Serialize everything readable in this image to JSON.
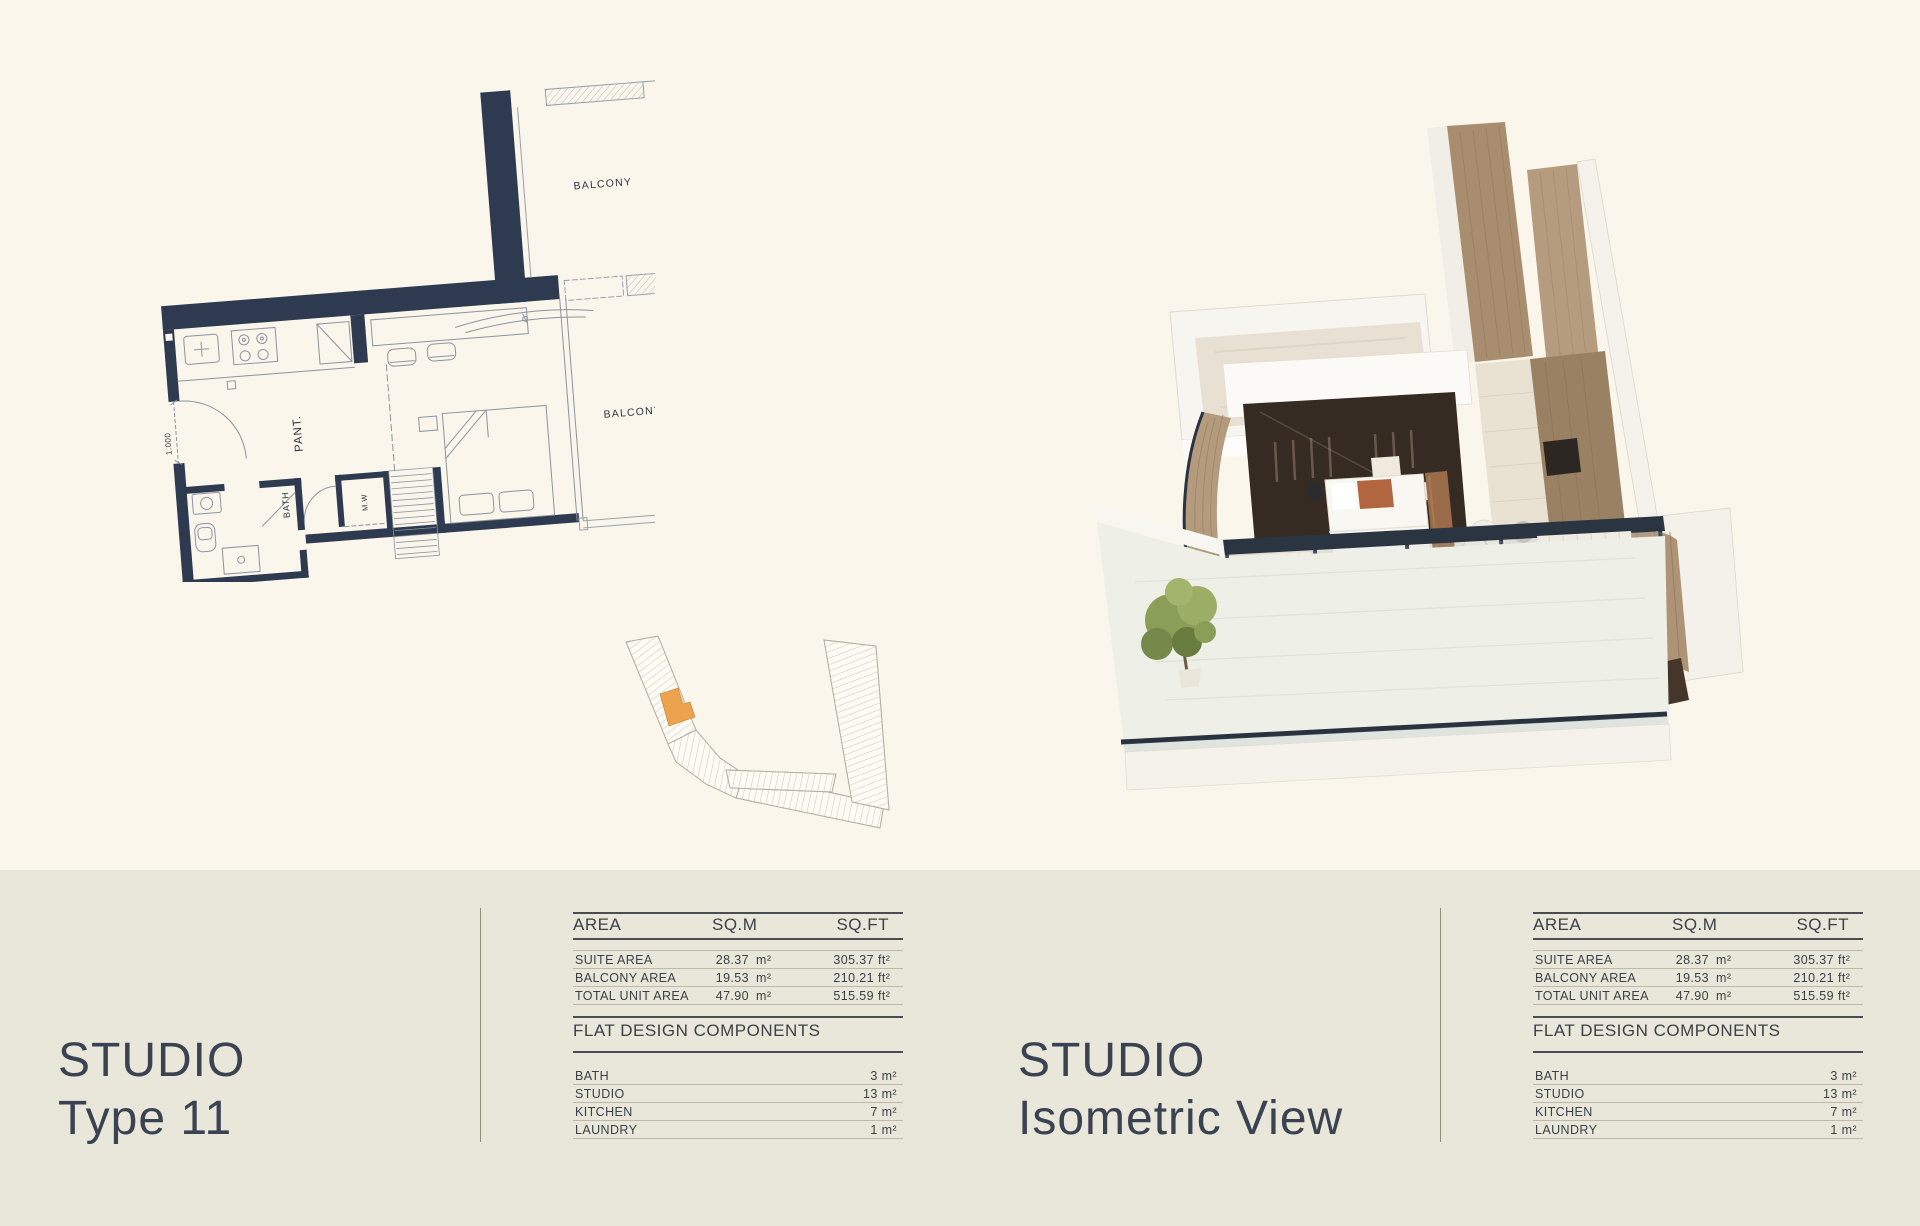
{
  "page": {
    "background_top": "#FAF6EC",
    "background_bottom": "#E9E7DA",
    "wall_navy": "#2d3a50",
    "highlight_orange": "#ECA24F"
  },
  "left_panel": {
    "title_line1": "STUDIO",
    "title_line2": "Type 11"
  },
  "middle_panel": {
    "title_line1": "STUDIO",
    "title_line2": "Isometric View"
  },
  "floor_plan": {
    "balcony_label": "BALCONY",
    "pantry_label": "PANT.",
    "bath_label": "BATH",
    "mw_label": "M.W",
    "dimension_label": "1.000"
  },
  "area_table": {
    "headers": {
      "area": "AREA",
      "sqm": "SQ.M",
      "sqft": "SQ.FT"
    },
    "rows": [
      {
        "label": "SUITE AREA",
        "sqm": "28.37",
        "sqm_unit": "m²",
        "sqft": "305.37",
        "sqft_unit": "ft²"
      },
      {
        "label": "BALCONY AREA",
        "sqm": "19.53",
        "sqm_unit": "m²",
        "sqft": "210.21",
        "sqft_unit": "ft²"
      },
      {
        "label": "TOTAL UNIT AREA",
        "sqm": "47.90",
        "sqm_unit": "m²",
        "sqft": "515.59",
        "sqft_unit": "ft²"
      }
    ],
    "components_title": "FLAT DESIGN COMPONENTS",
    "components": [
      {
        "label": "BATH",
        "value": "3 m²"
      },
      {
        "label": "STUDIO",
        "value": "13 m²"
      },
      {
        "label": "KITCHEN",
        "value": "7 m²"
      },
      {
        "label": "LAUNDRY",
        "value": "1 m²"
      }
    ]
  }
}
